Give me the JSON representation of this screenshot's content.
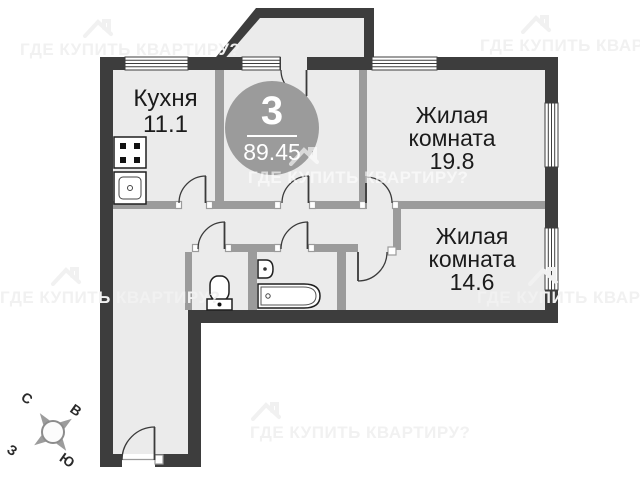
{
  "plan": {
    "badge": {
      "rooms_count": "3",
      "total_area": "89.45"
    },
    "rooms": [
      {
        "name": "Кухня",
        "area": "11.1"
      },
      {
        "name": "Жилая комната",
        "area": "19.8"
      },
      {
        "name": "Жилая комната",
        "area": "14.6"
      }
    ],
    "fixtures": [
      "stove",
      "kitchen-sink",
      "toilet",
      "wash-basin",
      "bathtub"
    ],
    "features": [
      "balcony",
      "entrance-door",
      "interior-doors",
      "windows"
    ]
  },
  "watermark": {
    "text": "ГДЕ КУПИТЬ КВАРТИРУ?"
  },
  "compass": {
    "north": "С",
    "east": "В",
    "west": "З",
    "south": "Ю"
  },
  "colors": {
    "wall_exterior": "#3d3d3d",
    "wall_interior": "#9b9b9b",
    "floor": "#ebebeb",
    "badge_bg": "#9b9b9b",
    "watermark": "#f1f1f1",
    "background": "#ffffff",
    "text": "#1b1b1b"
  }
}
